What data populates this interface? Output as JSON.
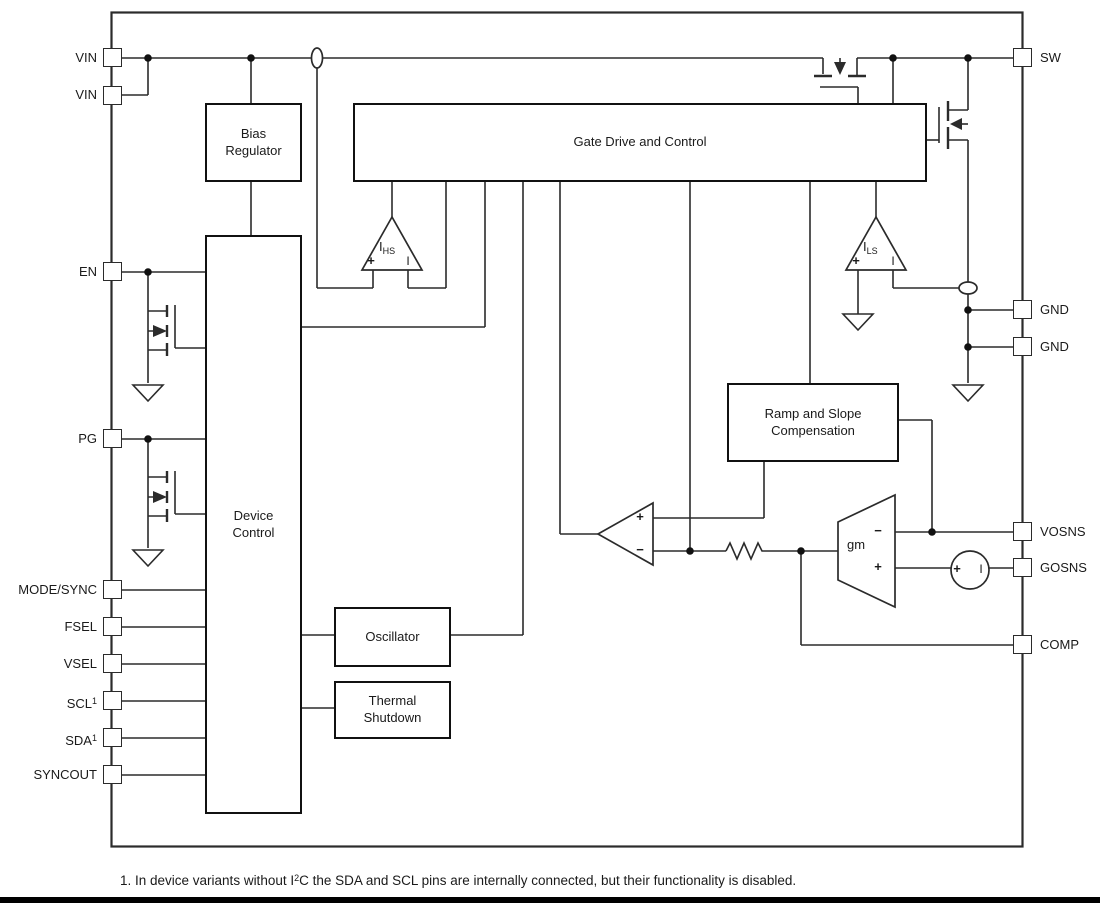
{
  "colors": {
    "line": "#2b2b2b",
    "text": "#1a1a1a",
    "footer_bar": "#000000"
  },
  "blocks": {
    "bias_regulator": {
      "label": "Bias\nRegulator"
    },
    "gate_drive": {
      "label": "Gate Drive and Control"
    },
    "device_control": {
      "label": "Device\nControl"
    },
    "oscillator": {
      "label": "Oscillator"
    },
    "thermal_shutdown": {
      "label": "Thermal\nShutdown"
    },
    "ramp_comp": {
      "label": "Ramp and Slope\nCompensation"
    }
  },
  "amplifiers": {
    "ihs": {
      "base": "I",
      "sub": "HS"
    },
    "ils": {
      "base": "I",
      "sub": "LS"
    },
    "gm": {
      "label": "gm"
    }
  },
  "symbols": {
    "plus": "+",
    "minus": "−",
    "bar": "I"
  },
  "pins": {
    "left": [
      {
        "label": "VIN"
      },
      {
        "label": "VIN"
      },
      {
        "label": "EN"
      },
      {
        "label": "PG"
      },
      {
        "label": "MODE/SYNC"
      },
      {
        "label": "FSEL"
      },
      {
        "label": "VSEL"
      },
      {
        "label": "SCL",
        "sup": "1"
      },
      {
        "label": "SDA",
        "sup": "1"
      },
      {
        "label": "SYNCOUT"
      }
    ],
    "right": [
      {
        "label": "SW"
      },
      {
        "label": "GND"
      },
      {
        "label": "GND"
      },
      {
        "label": "VOSNS"
      },
      {
        "label": "GOSNS"
      },
      {
        "label": "COMP"
      }
    ]
  },
  "footnote": {
    "pre": "1. In device variants without I",
    "sup": "2",
    "post": "C the SDA and SCL pins are internally connected, but their functionality is disabled."
  }
}
